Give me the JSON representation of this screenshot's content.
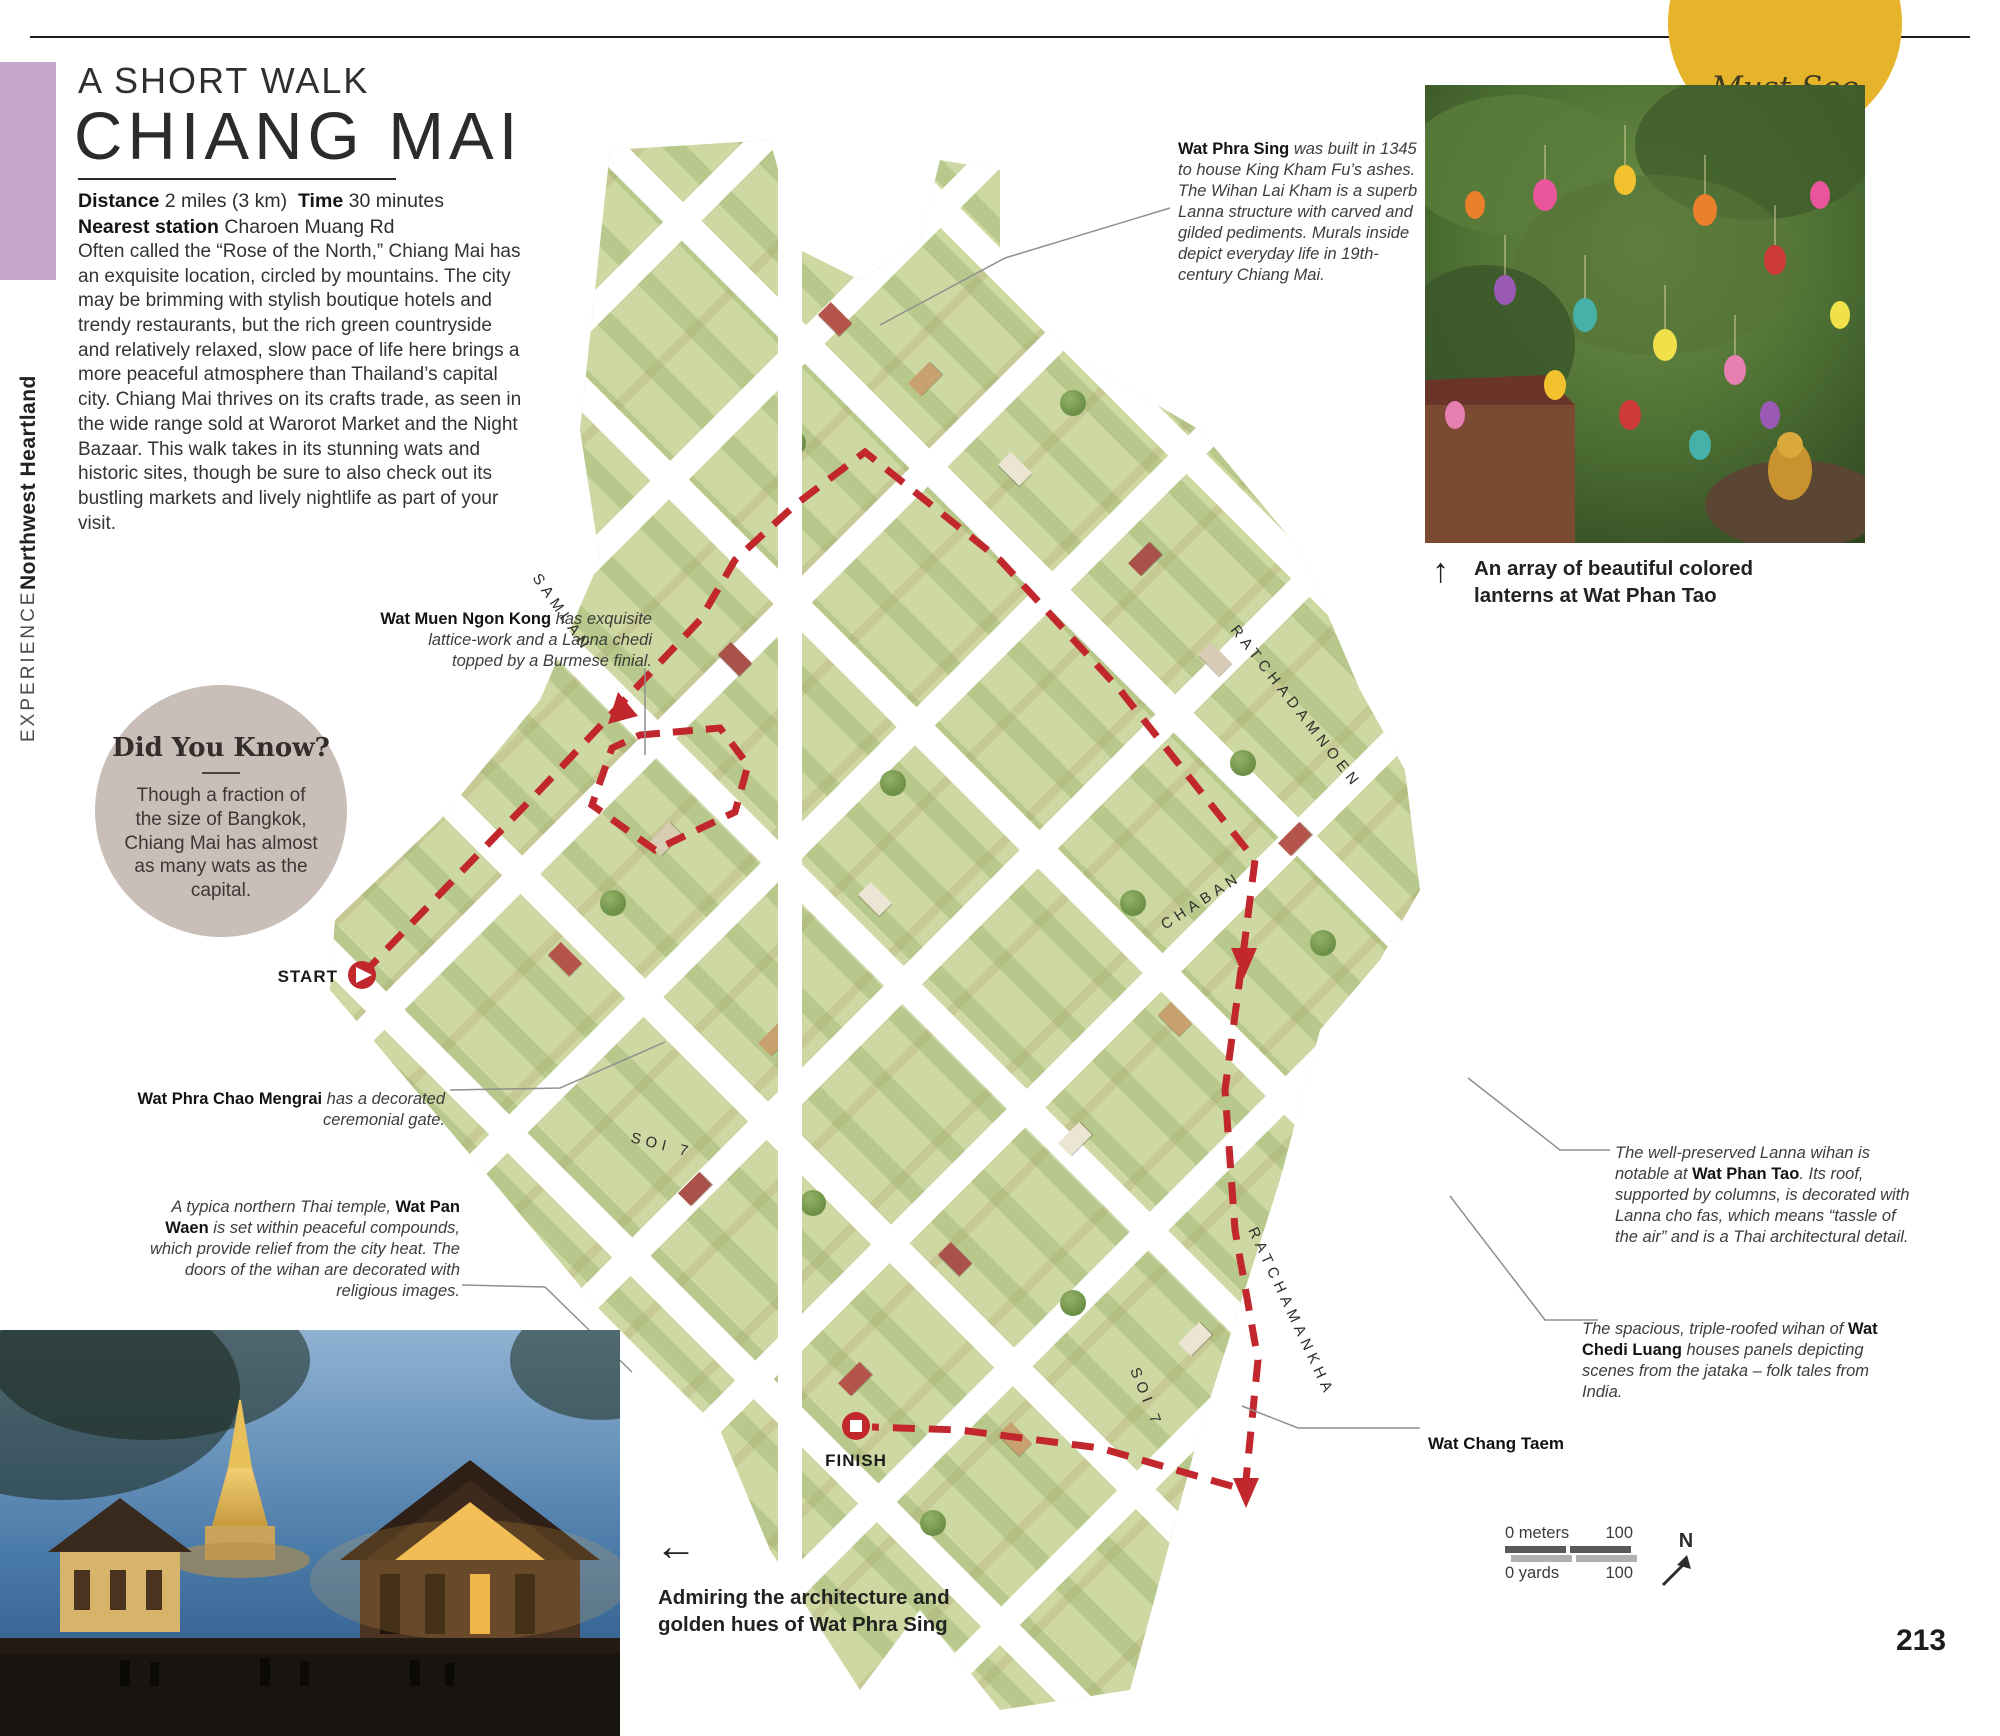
{
  "badge": {
    "label": "Must See"
  },
  "sidebar": {
    "experience": "EXPERIENCE",
    "region": "Northwest Heartland"
  },
  "header": {
    "kicker": "A SHORT WALK",
    "title": "CHIANG MAI"
  },
  "stats": {
    "distance_label": "Distance",
    "distance": "2 miles (3 km)",
    "time_label": "Time",
    "time": "30 minutes",
    "station_label": "Nearest station",
    "station": "Charoen Muang Rd"
  },
  "intro": "Often called the “Rose of the North,” Chiang Mai has an exquisite location, circled by mountains. The city may be brimming with stylish boutique hotels and trendy restaurants, but the rich green countryside and relatively relaxed, slow pace of life here brings a more peaceful atmosphere than Thailand’s capital city. Chiang Mai thrives on its crafts trade, as seen in the wide range sold at Warorot Market and the Night Bazaar. This walk takes in its stunning wats and historic sites, though be sure to also check out its bustling markets and lively nightlife as part of your visit.",
  "did_you_know": {
    "title": "Did You Know?",
    "body": "Though a fraction of the size of Bangkok, Chiang Mai has almost as many wats as the capital."
  },
  "callouts": {
    "wat_phra_sing": {
      "name": "Wat Phra Sing",
      "rest": " was built in 1345 to house King Kham Fu’s ashes. The Wihan Lai Kham is a superb Lanna structure with carved and gilded pediments. Murals inside depict everyday life in 19th-century Chiang Mai."
    },
    "wat_muen_ngon_kong": {
      "name": "Wat Muen Ngon Kong",
      "rest": " has exquisite lattice-work and a Lanna chedi topped by a Burmese finial."
    },
    "wat_phra_chao_mengrai": {
      "name": "Wat Phra Chao Mengrai",
      "rest": " has a decorated ceremonial gate."
    },
    "wat_pan_waen": {
      "pre": "A typica northern Thai temple, ",
      "name": "Wat Pan Waen",
      "rest": " is set within peaceful compounds, which provide relief from the city heat. The doors of the wihan are decorated with religious images."
    },
    "wat_phan_tao": {
      "pre": "The well-preserved Lanna wihan is notable at ",
      "name": "Wat Phan Tao",
      "rest": ". Its roof, supported by columns, is decorated with Lanna cho fas, which means “tassle of the air” and is a Thai architectural detail."
    },
    "wat_chedi_luang": {
      "pre": "The spacious, triple-roofed wihan of ",
      "name": "Wat Chedi Luang",
      "rest": " houses panels depicting scenes from the jataka – folk tales from India."
    },
    "wat_chang_taem": {
      "name": "Wat Chang Taem"
    }
  },
  "map": {
    "streets": {
      "samlan": "SAMLAN",
      "ratchadamnoen": "RATCHADAMNOEN",
      "chaban": "CHABAN",
      "ratchamankha": "RATCHAMANKHA",
      "soi7_a": "SOI 7",
      "soi7_b": "SOI 7"
    },
    "start_label": "START",
    "finish_label": "FINISH",
    "route_color": "#c1272d"
  },
  "captions": {
    "lanterns": "An array of beautiful colored lanterns at Wat Phan Tao",
    "temple": "Admiring the architecture and golden hues of Wat Phra Sing"
  },
  "icons": {
    "up_arrow": "↑",
    "left_arrow": "←"
  },
  "scale_bar": {
    "meters_start": "0 meters",
    "meters_end": "100",
    "yards_start": "0 yards",
    "yards_end": "100",
    "north": "N"
  },
  "page_number": "213",
  "colors": {
    "accent_purple": "#c4a5cc",
    "badge_yellow": "#e5b42b",
    "circle_taupe": "#c9beb8",
    "route_red": "#c1272d",
    "map_green": "#cdd8a2"
  }
}
